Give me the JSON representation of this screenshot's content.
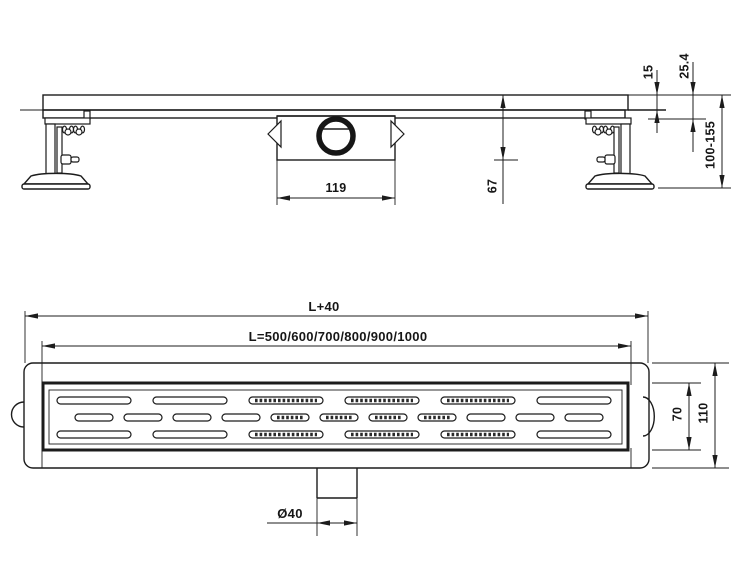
{
  "colors": {
    "background": "#ffffff",
    "line": "#1c1c1c"
  },
  "side_view": {
    "dims": {
      "grate_thickness": "15",
      "edge_height": "25.4",
      "install_height": "100-155",
      "trap_height": "67",
      "trap_width": "119"
    }
  },
  "plan_view": {
    "dims": {
      "total_length": "L+40",
      "channel_lengths": "L=500/600/700/800/900/1000",
      "grate_width": "70",
      "total_width": "110",
      "outlet_diameter": "Ø40"
    },
    "grate_pattern": {
      "long_rows_y": [
        397,
        431
      ],
      "long_slot": {
        "start_x": 57,
        "width": 74,
        "height": 7,
        "pitch": 96,
        "count": 6
      },
      "short_row_y": 414,
      "short_slot": {
        "start_x": 75,
        "width": 38,
        "height": 7,
        "pitch": 49,
        "count": 11
      },
      "hatched_x_range": [
        280,
        480
      ]
    }
  }
}
